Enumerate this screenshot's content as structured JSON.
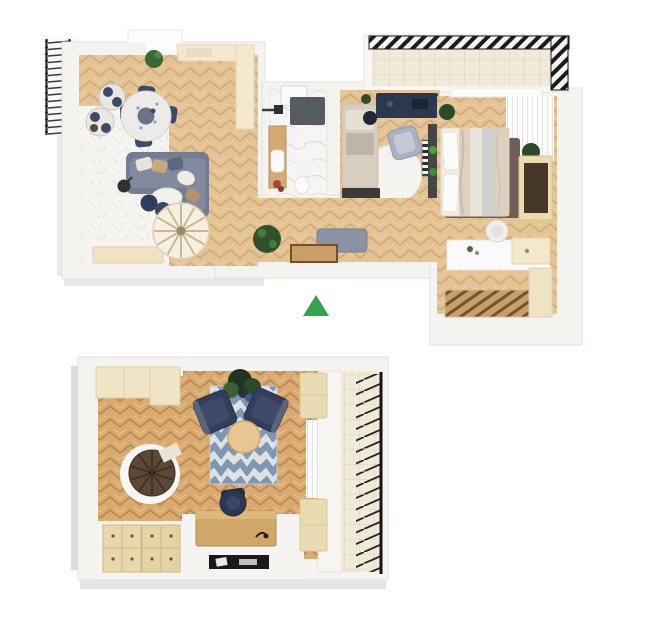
{
  "canvas": {
    "width": 660,
    "height": 643,
    "background": "#ffffff"
  },
  "palette": {
    "wall": "#f4f3f0",
    "wall_outline": "#e3e1dd",
    "wood_light": "#e4c394",
    "wood_light_line": "#d0a975",
    "wood_dark": "#d9aa71",
    "wood_dark_line": "#bb8a50",
    "white_rug": "#f5f4f0",
    "marble": "#f6f5f3",
    "tile": "#f1ead8",
    "tile_line": "#ddd2ba",
    "railing_black": "#1c1c1c",
    "sofa_blue_gray": "#747c92",
    "navy": "#32405e",
    "chair_gray_blue": "#a9b2c2",
    "rug_chevron_blue": "#8096b1",
    "rug_chevron_light": "#dde2e4",
    "cream_cabinet": "#ecdfb9",
    "cream_counter": "#f4e9cd",
    "desk_wood": "#d0a768",
    "stair_brown": "#5c4836",
    "dark_rug_brown": "#6e6058",
    "bed_linen": "#f1ece4",
    "blanket_beige": "#ddd0bd",
    "plant_green": "#30502b",
    "marker_green": "#35a24c",
    "shadow_gray": "#b9c1ca",
    "dark_furniture": "#2c3850"
  },
  "upper_floor": {
    "title": "upper-floor-plan",
    "rooms": [
      "living-dining-room",
      "kitchenette",
      "bathroom",
      "home-office",
      "hallway",
      "bedroom",
      "balcony-left",
      "balcony-top-right"
    ],
    "furniture": {
      "living_dining": [
        "round-dining-table",
        "dining-chairs-navy",
        "round-lounge-chairs",
        "sofa-with-pillows",
        "coffee-table-oval",
        "navy-poufs",
        "floor-lamp",
        "white-fur-rug",
        "sideboard",
        "spiral-staircase",
        "potted-plant"
      ],
      "kitchenette": [
        "cream-counter",
        "window"
      ],
      "bathroom": [
        "skylight",
        "shower",
        "wood-vanity",
        "sink",
        "red-flowers",
        "wall-fixture"
      ],
      "home_office": [
        "navy-desk",
        "desk-chair",
        "daybed",
        "round-white-rug",
        "striped-mat",
        "wall-shelf-with-plants",
        "dark-console"
      ],
      "hallway": [
        "gray-bench",
        "potted-plant",
        "wood-doormat"
      ],
      "bedroom": [
        "double-bed",
        "pillows",
        "dark-area-rug",
        "potted-plants",
        "wardrobe",
        "white-curtains",
        "vanity-desk",
        "white-chair",
        "sliding-door-closet",
        "cream-cabinet"
      ]
    }
  },
  "lower_floor": {
    "title": "lower-floor-plan",
    "rooms": [
      "studio-room",
      "balcony-right"
    ],
    "furniture": [
      "cream-wardrobe",
      "spiral-staircase",
      "chevron-rug",
      "navy-armchairs",
      "round-coffee-table",
      "potted-plant",
      "side-cabinets",
      "wood-desk",
      "office-chair",
      "desk-lamp",
      "black-doormat",
      "chest-of-drawers",
      "white-curtain"
    ]
  },
  "marker": {
    "shape": "triangle-up",
    "color": "#35a24c"
  }
}
